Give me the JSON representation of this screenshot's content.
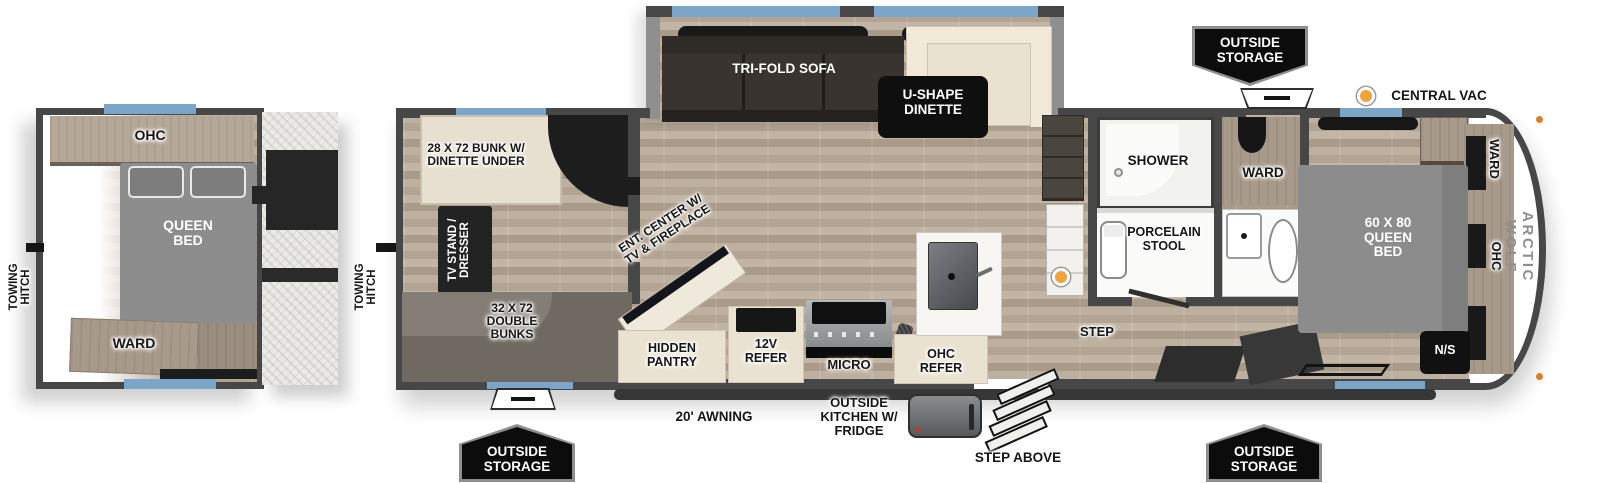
{
  "colors": {
    "accent_blue": "#7ba6c9",
    "marker_orange": "#f2a33c",
    "wall_gray": "#474747",
    "badge_black": "#0c0c0c"
  },
  "left_plan": {
    "ohc": "OHC",
    "queen_bed": "QUEEN BED",
    "ward": "WARD",
    "towing_hitch": "TOWING HITCH"
  },
  "main_plan": {
    "towing_hitch": "TOWING HITCH",
    "bunk_over_dinette": "28 X 72 BUNK W/ DINETTE UNDER",
    "tv_stand_dresser": "TV STAND / DRESSER",
    "double_bunks": "32 X 72 DOUBLE BUNKS",
    "tri_fold_sofa": "TRI-FOLD SOFA",
    "u_shape_dinette": "U-SHAPE DINETTE",
    "ent_center": "ENT. CENTER W/ TV & FIREPLACE",
    "hidden_pantry": "HIDDEN PANTRY",
    "refer_12v": "12V REFER",
    "micro": "MICRO",
    "ohc_refer": "OHC REFER",
    "shower": "SHOWER",
    "bath_ward": "WARD",
    "porcelain_stool": "PORCELAIN STOOL",
    "step": "STEP",
    "queen_bed": "60 X 80 QUEEN BED",
    "bedroom_ward": "WARD",
    "bedroom_ohc": "OHC",
    "nightstand": "N/S",
    "central_vac": "CENTRAL VAC",
    "brand": "ARCTIC WOLF"
  },
  "exterior": {
    "outside_storage_top": "OUTSIDE STORAGE",
    "outside_storage_front": "OUTSIDE STORAGE",
    "outside_storage_rear": "OUTSIDE STORAGE",
    "awning": "20' AWNING",
    "outside_kitchen": "OUTSIDE KITCHEN W/ FRIDGE",
    "step_above": "STEP ABOVE"
  }
}
